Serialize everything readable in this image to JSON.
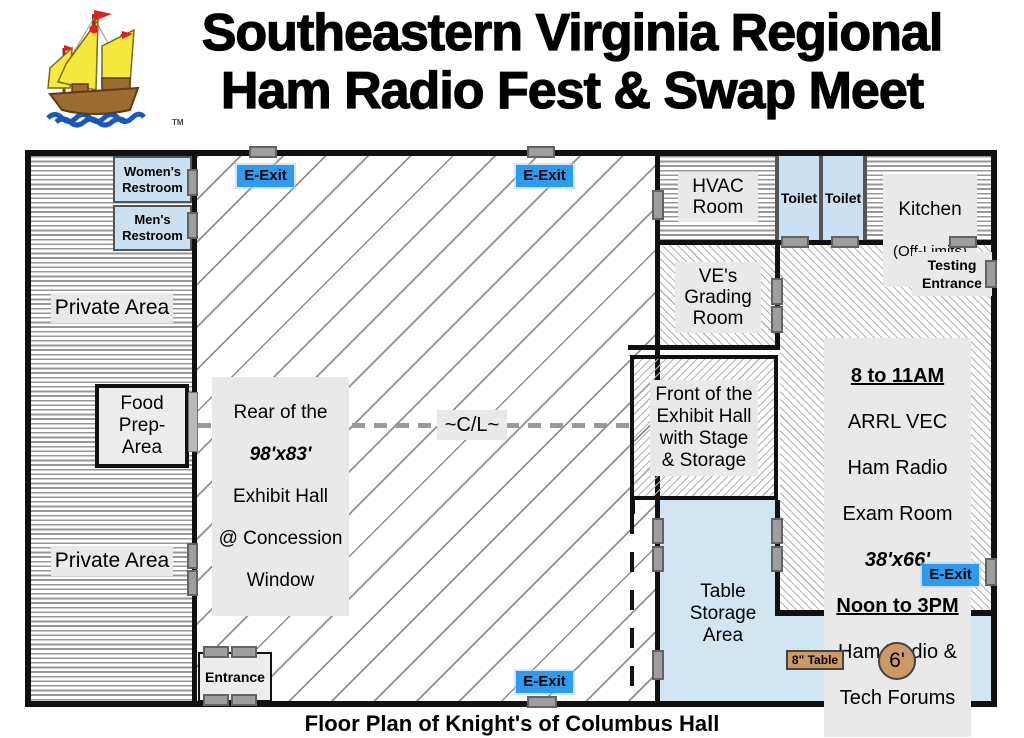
{
  "header": {
    "title_line1": "Southeastern Virginia Regional",
    "title_line2": "Ham Radio Fest & Swap Meet",
    "trademark": "TM"
  },
  "colors": {
    "exit_blue": "#2D9BF0",
    "room_light_blue": "#CBE0F0",
    "storage_light_blue": "#D2E6F2",
    "label_gray": "#E9E9E9",
    "door_gray": "#9E9E9E",
    "table_tan": "#CD9A66",
    "wall_black": "#111111"
  },
  "plan": {
    "womens_restroom": "Women's\nRestroom",
    "mens_restroom": "Men's\nRestroom",
    "private_area": "Private Area",
    "food_prep": "Food\nPrep-Area",
    "rear_label": {
      "l1": "Rear of the",
      "l2": "98'x83'",
      "l3": "Exhibit Hall",
      "l4": "@ Concession",
      "l5": "Window"
    },
    "centerline": "~C/L~",
    "e_exit": "E-Exit",
    "entrance": "Entrance",
    "hvac": "HVAC\nRoom",
    "toilet": "Toilet",
    "kitchen_l1": "Kitchen",
    "kitchen_l2": "(Off-Limits)",
    "ve_grading": "VE's\nGrading\nRoom",
    "testing_entrance": "Testing\nEntrance",
    "exam": {
      "l1": "8 to 11AM",
      "l2": "ARRL VEC",
      "l3": "Ham Radio",
      "l4": "Exam Room",
      "l5": "38'x66'",
      "l6": "Noon to 3PM",
      "l7": "Ham Radio &",
      "l8": "Tech Forums"
    },
    "front_exhibit": "Front of the\nExhibit Hall\nwith Stage\n& Storage",
    "table_storage": "Table\nStorage\nArea",
    "table_8ft": "8\" Table",
    "table_6ft": "6'"
  },
  "footer": {
    "caption": "Floor Plan of Knight's of Columbus Hall"
  }
}
